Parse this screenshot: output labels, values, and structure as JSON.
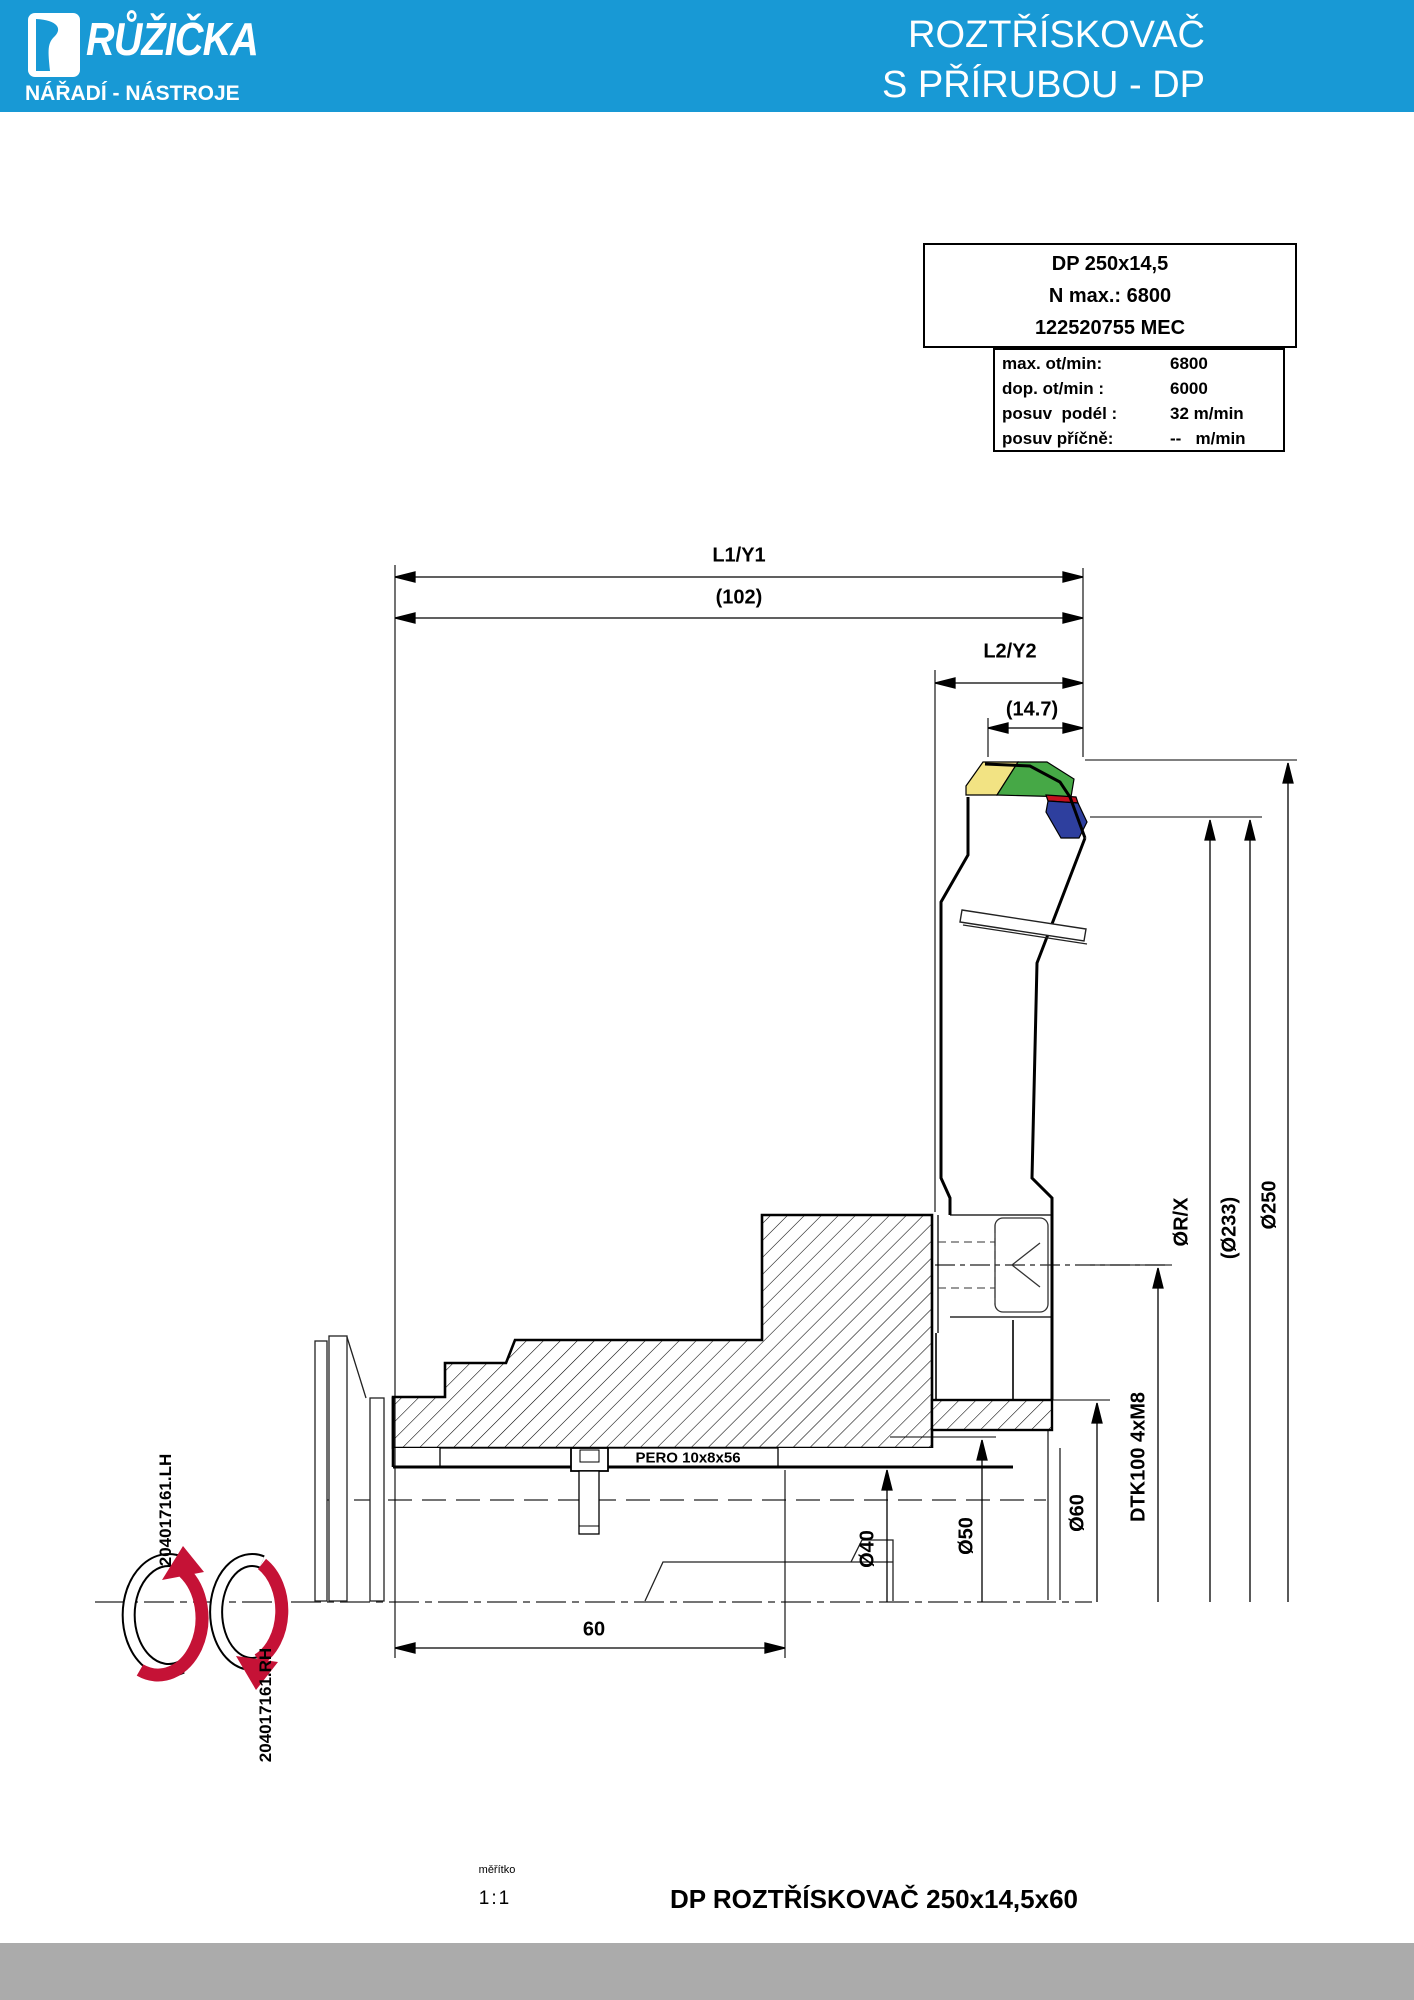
{
  "header": {
    "logo_title": "RŮŽIČKA",
    "logo_subtitle": "NÁŘADÍ - NÁSTROJE",
    "title_line1": "ROZTŘÍSKOVAČ",
    "title_line2": "S PŘÍRUBOU - DP",
    "brand_blue": "#1899d5"
  },
  "spec_box": {
    "model": "DP 250x14,5",
    "n_max": "N max.: 6800",
    "code": "122520755 MEC",
    "params": [
      {
        "label": "max. ot/min:",
        "value": "6800"
      },
      {
        "label": "dop. ot/min :",
        "value": "6000"
      },
      {
        "label": "posuv  podél :",
        "value": "32 m/min"
      },
      {
        "label": "posuv příčně:",
        "value": "--   m/min"
      }
    ]
  },
  "dimensions": {
    "l1": "L1/Y1",
    "l1_value": "(102)",
    "l2": "L2/Y2",
    "l2_value": "(14.7)",
    "dia_250": "Ø250",
    "dia_233": "(Ø233)",
    "dia_rx": "ØR/X",
    "bolt_circle": "DTK100 4xM8",
    "dia_60": "Ø60",
    "dia_50": "Ø50",
    "dia_40": "Ø40",
    "length_60": "60",
    "key_label": "PERO 10x8x56",
    "part_lh": "204017161.LH",
    "part_rh": "204017161.RH"
  },
  "insert_colors": {
    "yellow": "#f2e383",
    "green": "#46a846",
    "red": "#c50f1e",
    "blue": "#2e3f9e",
    "arrow_red": "#c51236"
  },
  "footer": {
    "scale_label": "měřítko",
    "scale_value": "1:1",
    "title": "DP ROZTŘÍSKOVAČ 250x14,5x60"
  }
}
